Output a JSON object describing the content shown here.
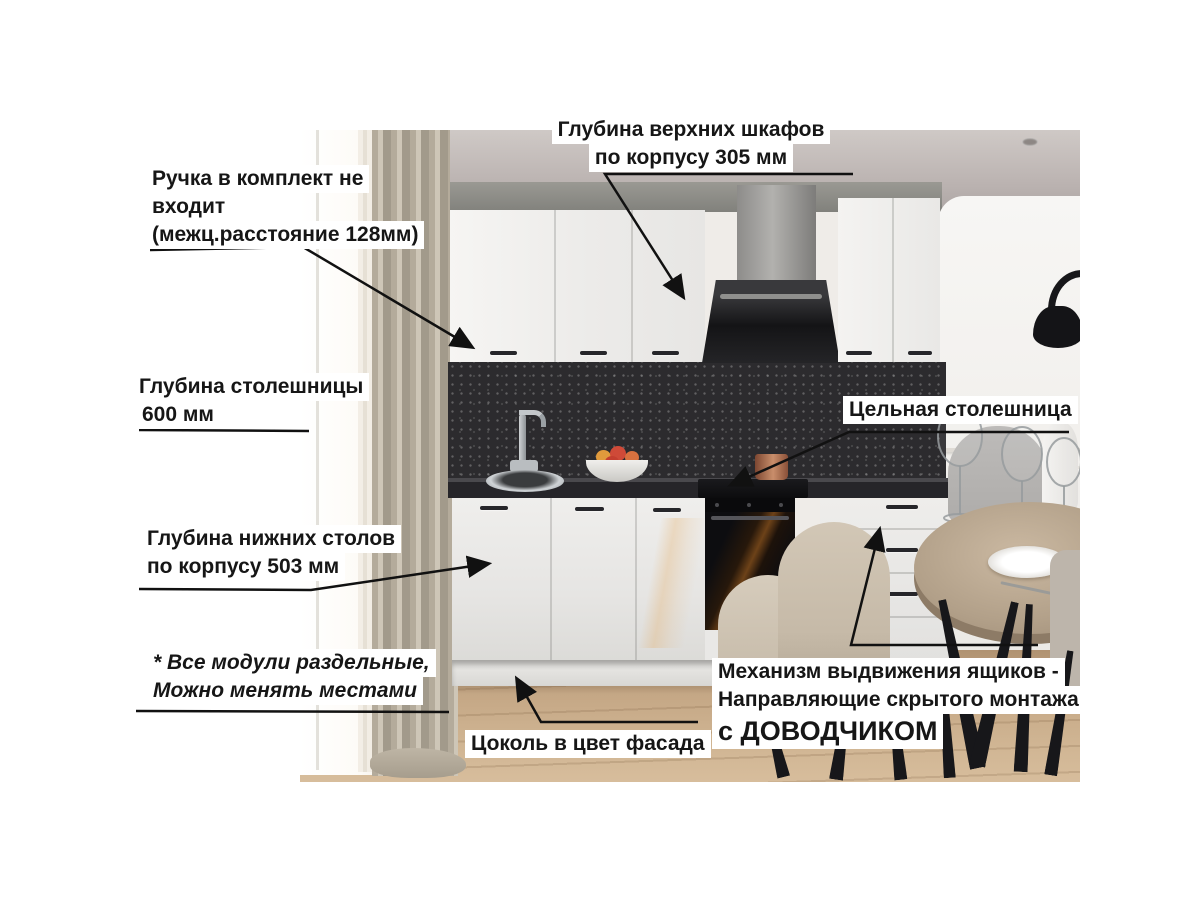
{
  "palette": {
    "page_bg": "#ffffff",
    "label_bg": "#ffffff",
    "label_text": "#161616",
    "leader_line": "#111111",
    "cabinet_white": "#f1f0ee",
    "granite_dark": "#2c2b2e",
    "worktop_dark": "#232227",
    "floor_wood": "#c7ab89",
    "curtain_beige": "#b2a898",
    "ceiling_grey": "#b9b2b0",
    "soffit_grey": "#8d8d88",
    "appliance_black": "#131316",
    "hood_steel": "#9b9a98",
    "table_oak": "#b3a08a",
    "chair_beige": "#ccc1b1",
    "chair_grey": "#b6b4b2"
  },
  "annotations": {
    "upper_depth": {
      "lines": [
        "Глубина верхних шкафов",
        "по корпусу 305 мм"
      ]
    },
    "handle_note": {
      "lines": [
        "Ручка в комплект не",
        "входит",
        "(межц.расстояние 128мм)"
      ]
    },
    "worktop_depth": {
      "lines": [
        "Глубина столешницы",
        "600 мм"
      ]
    },
    "solid_worktop": {
      "lines": [
        "Цельная столешница"
      ]
    },
    "base_depth": {
      "lines": [
        "Глубина нижних столов",
        "по корпусу 503 мм"
      ]
    },
    "modules_note": {
      "lines": [
        "* Все модули раздельные,",
        "Можно менять местами"
      ]
    },
    "plinth_note": {
      "lines": [
        "Цоколь в цвет фасада"
      ]
    },
    "drawers_note": {
      "lines": [
        "Механизм выдвижения ящиков -",
        "Направляющие скрытого монтажа",
        "с ДОВОДЧИКОМ"
      ]
    }
  }
}
